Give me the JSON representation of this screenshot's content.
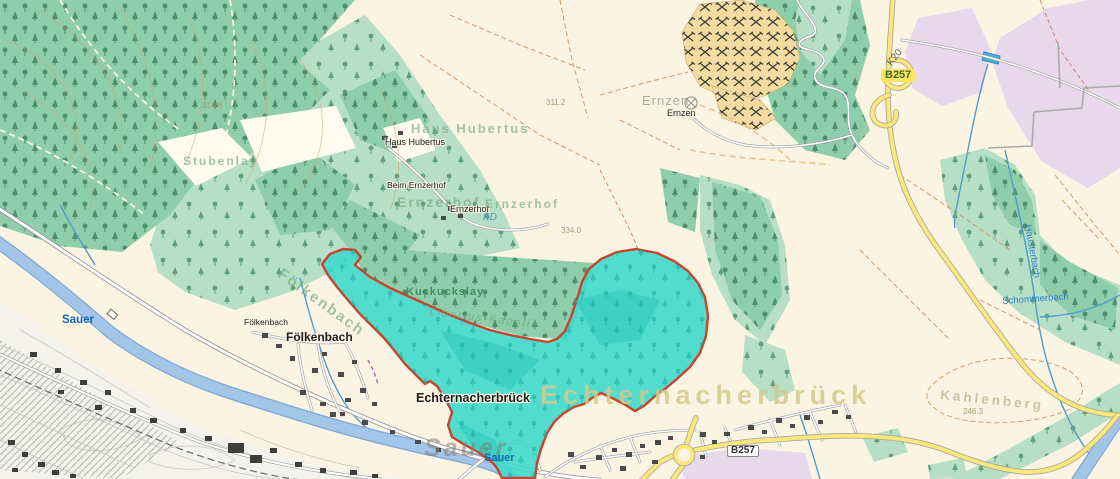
{
  "map": {
    "colors": {
      "background": "#FCF4E2",
      "selection_fill": "#3FD9CC",
      "selection_border": "#C7432C",
      "forest_medium": "#8FCEAB",
      "forest_light": "#B7DFC5",
      "river": "#A3C6E8",
      "road_yellow": "#FBE878",
      "lavender": "#E9D7EC",
      "quarry": "#F4DCA0",
      "water_label": "#1565C0"
    },
    "labels": [
      {
        "id": "ghost-haus-hubertus",
        "text": "Haus Hubertus",
        "cls": "gG",
        "x": 411,
        "y": 122,
        "size": 13
      },
      {
        "id": "haus-hubertus",
        "text": "Haus Hubertus",
        "cls": "poi halo",
        "x": 385,
        "y": 138
      },
      {
        "id": "beim-ernzerhof",
        "text": "Beim Ernzerhof",
        "cls": "poi halo",
        "x": 387,
        "y": 181,
        "size": 8.5
      },
      {
        "id": "ghost-ernzerhof-west",
        "text": "Ernzerhof",
        "cls": "gG",
        "x": 397,
        "y": 195,
        "size": 14
      },
      {
        "id": "ernzerhof",
        "text": "Ernzerhof",
        "cls": "poi halo",
        "x": 450,
        "y": 205
      },
      {
        "id": "ghost-ernzerhof-east",
        "text": "Ernzerhof",
        "cls": "gG",
        "x": 485,
        "y": 198,
        "size": 12
      },
      {
        "id": "kd",
        "text": "KD",
        "cls": "wIt",
        "x": 483,
        "y": 213
      },
      {
        "id": "elev-311",
        "text": "311.2",
        "cls": "elev",
        "x": 546,
        "y": 99
      },
      {
        "id": "elev-334",
        "text": "334.0",
        "cls": "elev",
        "x": 561,
        "y": 227
      },
      {
        "id": "elev-314",
        "text": "314.6",
        "cls": "elev",
        "x": 202,
        "y": 102
      },
      {
        "id": "elev-246",
        "text": "246.3",
        "cls": "elev",
        "x": 963,
        "y": 408
      },
      {
        "id": "ghost-ernzen",
        "text": "Ernzen",
        "cls": "gGr",
        "x": 642,
        "y": 94,
        "size": 13
      },
      {
        "id": "ernzen",
        "text": "Ernzen",
        "cls": "poi halo",
        "x": 667,
        "y": 109
      },
      {
        "id": "foelkenbach-small",
        "text": "Fölkenbach",
        "cls": "poi halo",
        "x": 244,
        "y": 318,
        "size": 8.5
      },
      {
        "id": "foelkenbach",
        "text": "Fölkenbach",
        "cls": "town halo",
        "x": 286,
        "y": 331
      },
      {
        "id": "ghost-foelkenbach",
        "text": "Fölkenbach",
        "cls": "gG",
        "x": 284,
        "y": 266,
        "rot": 36,
        "size": 15
      },
      {
        "id": "kuckuckslay",
        "text": "Kuckuckslay",
        "cls": "fG",
        "x": 406,
        "y": 287
      },
      {
        "id": "liborius-kapelle",
        "text": "Liborius-Kapelle",
        "cls": "gIt",
        "x": 430,
        "y": 307,
        "rot": 7
      },
      {
        "id": "echternacherbrueck",
        "text": "Echternacherbrück",
        "cls": "town halo",
        "x": 416,
        "y": 392,
        "size": 12.5
      },
      {
        "id": "ghost-echternacherbrueck",
        "text": "Echternacherbrück",
        "cls": "gY",
        "x": 540,
        "y": 382,
        "size": 27
      },
      {
        "id": "sauer-ghost",
        "text": "Sauer",
        "cls": "riv",
        "x": 424,
        "y": 436
      },
      {
        "id": "sauer-blue-1",
        "text": "Sauer",
        "cls": "wB",
        "x": 484,
        "y": 453
      },
      {
        "id": "sauer-blue-2",
        "text": "Sauer",
        "cls": "wB",
        "x": 62,
        "y": 315,
        "size": 11.5
      },
      {
        "id": "kahlenberg",
        "text": "Kahlenberg",
        "cls": "gT",
        "x": 941,
        "y": 388,
        "rot": 6,
        "size": 13.5
      },
      {
        "id": "stubenlay",
        "text": "Stubenlay",
        "cls": "gG",
        "x": 183,
        "y": 155,
        "size": 12
      },
      {
        "id": "shield-b257-top",
        "text": "B257",
        "cls": "shY",
        "x": 881,
        "y": 69
      },
      {
        "id": "shield-b257-bottom",
        "text": "B257",
        "cls": "shW",
        "x": 727,
        "y": 445
      },
      {
        "id": "k20",
        "text": "K20",
        "cls": "rd",
        "x": 886,
        "y": 62,
        "rot": -52
      },
      {
        "id": "hausterbach",
        "text": "Hausterbach",
        "cls": "wS",
        "x": 1032,
        "y": 224,
        "rot": 80
      },
      {
        "id": "schommerbach",
        "text": "Schommerbach",
        "cls": "wS",
        "x": 1002,
        "y": 297,
        "rot": -4
      }
    ]
  }
}
